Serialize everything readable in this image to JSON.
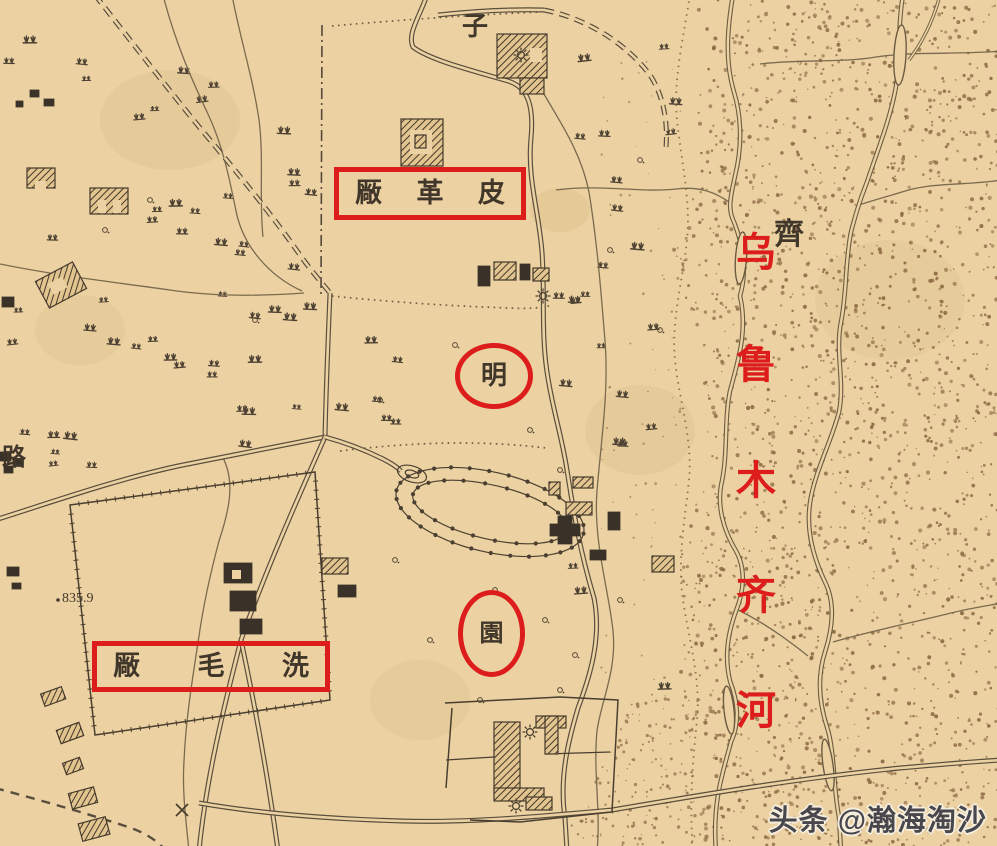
{
  "palette": {
    "paper": "#ecd2a2",
    "ink": "#4a4034",
    "red": "#dd1c1c"
  },
  "map_labels": {
    "zi": "子",
    "qi": "齊",
    "lu": "路",
    "elevation": "835.9"
  },
  "annotations": {
    "box_leather_factory": {
      "chars": [
        "厰",
        "革",
        "皮"
      ]
    },
    "box_wool_washing": {
      "chars": [
        "厰",
        "毛",
        "洗"
      ]
    },
    "circle_ming": {
      "label": "明"
    },
    "circle_yuan": {
      "label": "園"
    },
    "river_name": {
      "chars": [
        "乌",
        "鲁",
        "木",
        "齐",
        "河"
      ]
    }
  },
  "watermark": {
    "text": "头条 @瀚海淘沙"
  }
}
